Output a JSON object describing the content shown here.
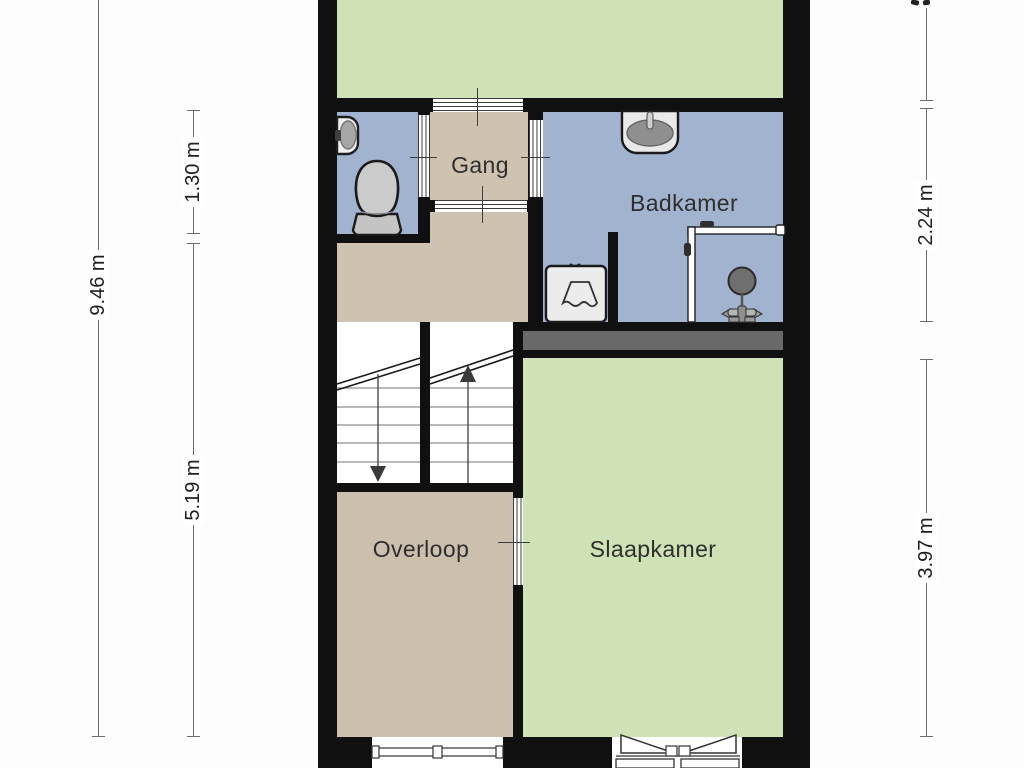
{
  "floorplan": {
    "rooms": {
      "gang": {
        "label": "Gang"
      },
      "badkamer": {
        "label": "Badkamer"
      },
      "overloop": {
        "label": "Overloop"
      },
      "slaapkamer": {
        "label": "Slaapkamer"
      }
    },
    "dimensions": {
      "left_total": {
        "label": "9.46 m"
      },
      "left_gang": {
        "label": "1.30 m"
      },
      "left_lower": {
        "label": "5.19 m"
      },
      "right_badkamer": {
        "label": "2.24 m"
      },
      "right_slaapkamer": {
        "label": "3.97 m"
      }
    },
    "fixtures": {
      "toilet": "toilet-icon",
      "corner_sink": "corner-sink-icon",
      "washbasin": "washbasin-icon",
      "washing_machine": "washing-machine-icon",
      "shower": "shower-icon"
    },
    "stairs": {
      "left_flight": "stairs-down-arrow",
      "right_flight": "stairs-up-arrow"
    },
    "openings": [
      "overloop-window",
      "slaapkamer-french-doors",
      "interior-doors"
    ],
    "colors": {
      "wall": "#101010",
      "floor_green": "#cfe2b5",
      "floor_blue": "#a2b3cf",
      "floor_taupe": "#ccbfae",
      "closet_gray": "#696969",
      "dimension_line": "#6b6b6b",
      "label_text": "#2e2e2e"
    }
  }
}
